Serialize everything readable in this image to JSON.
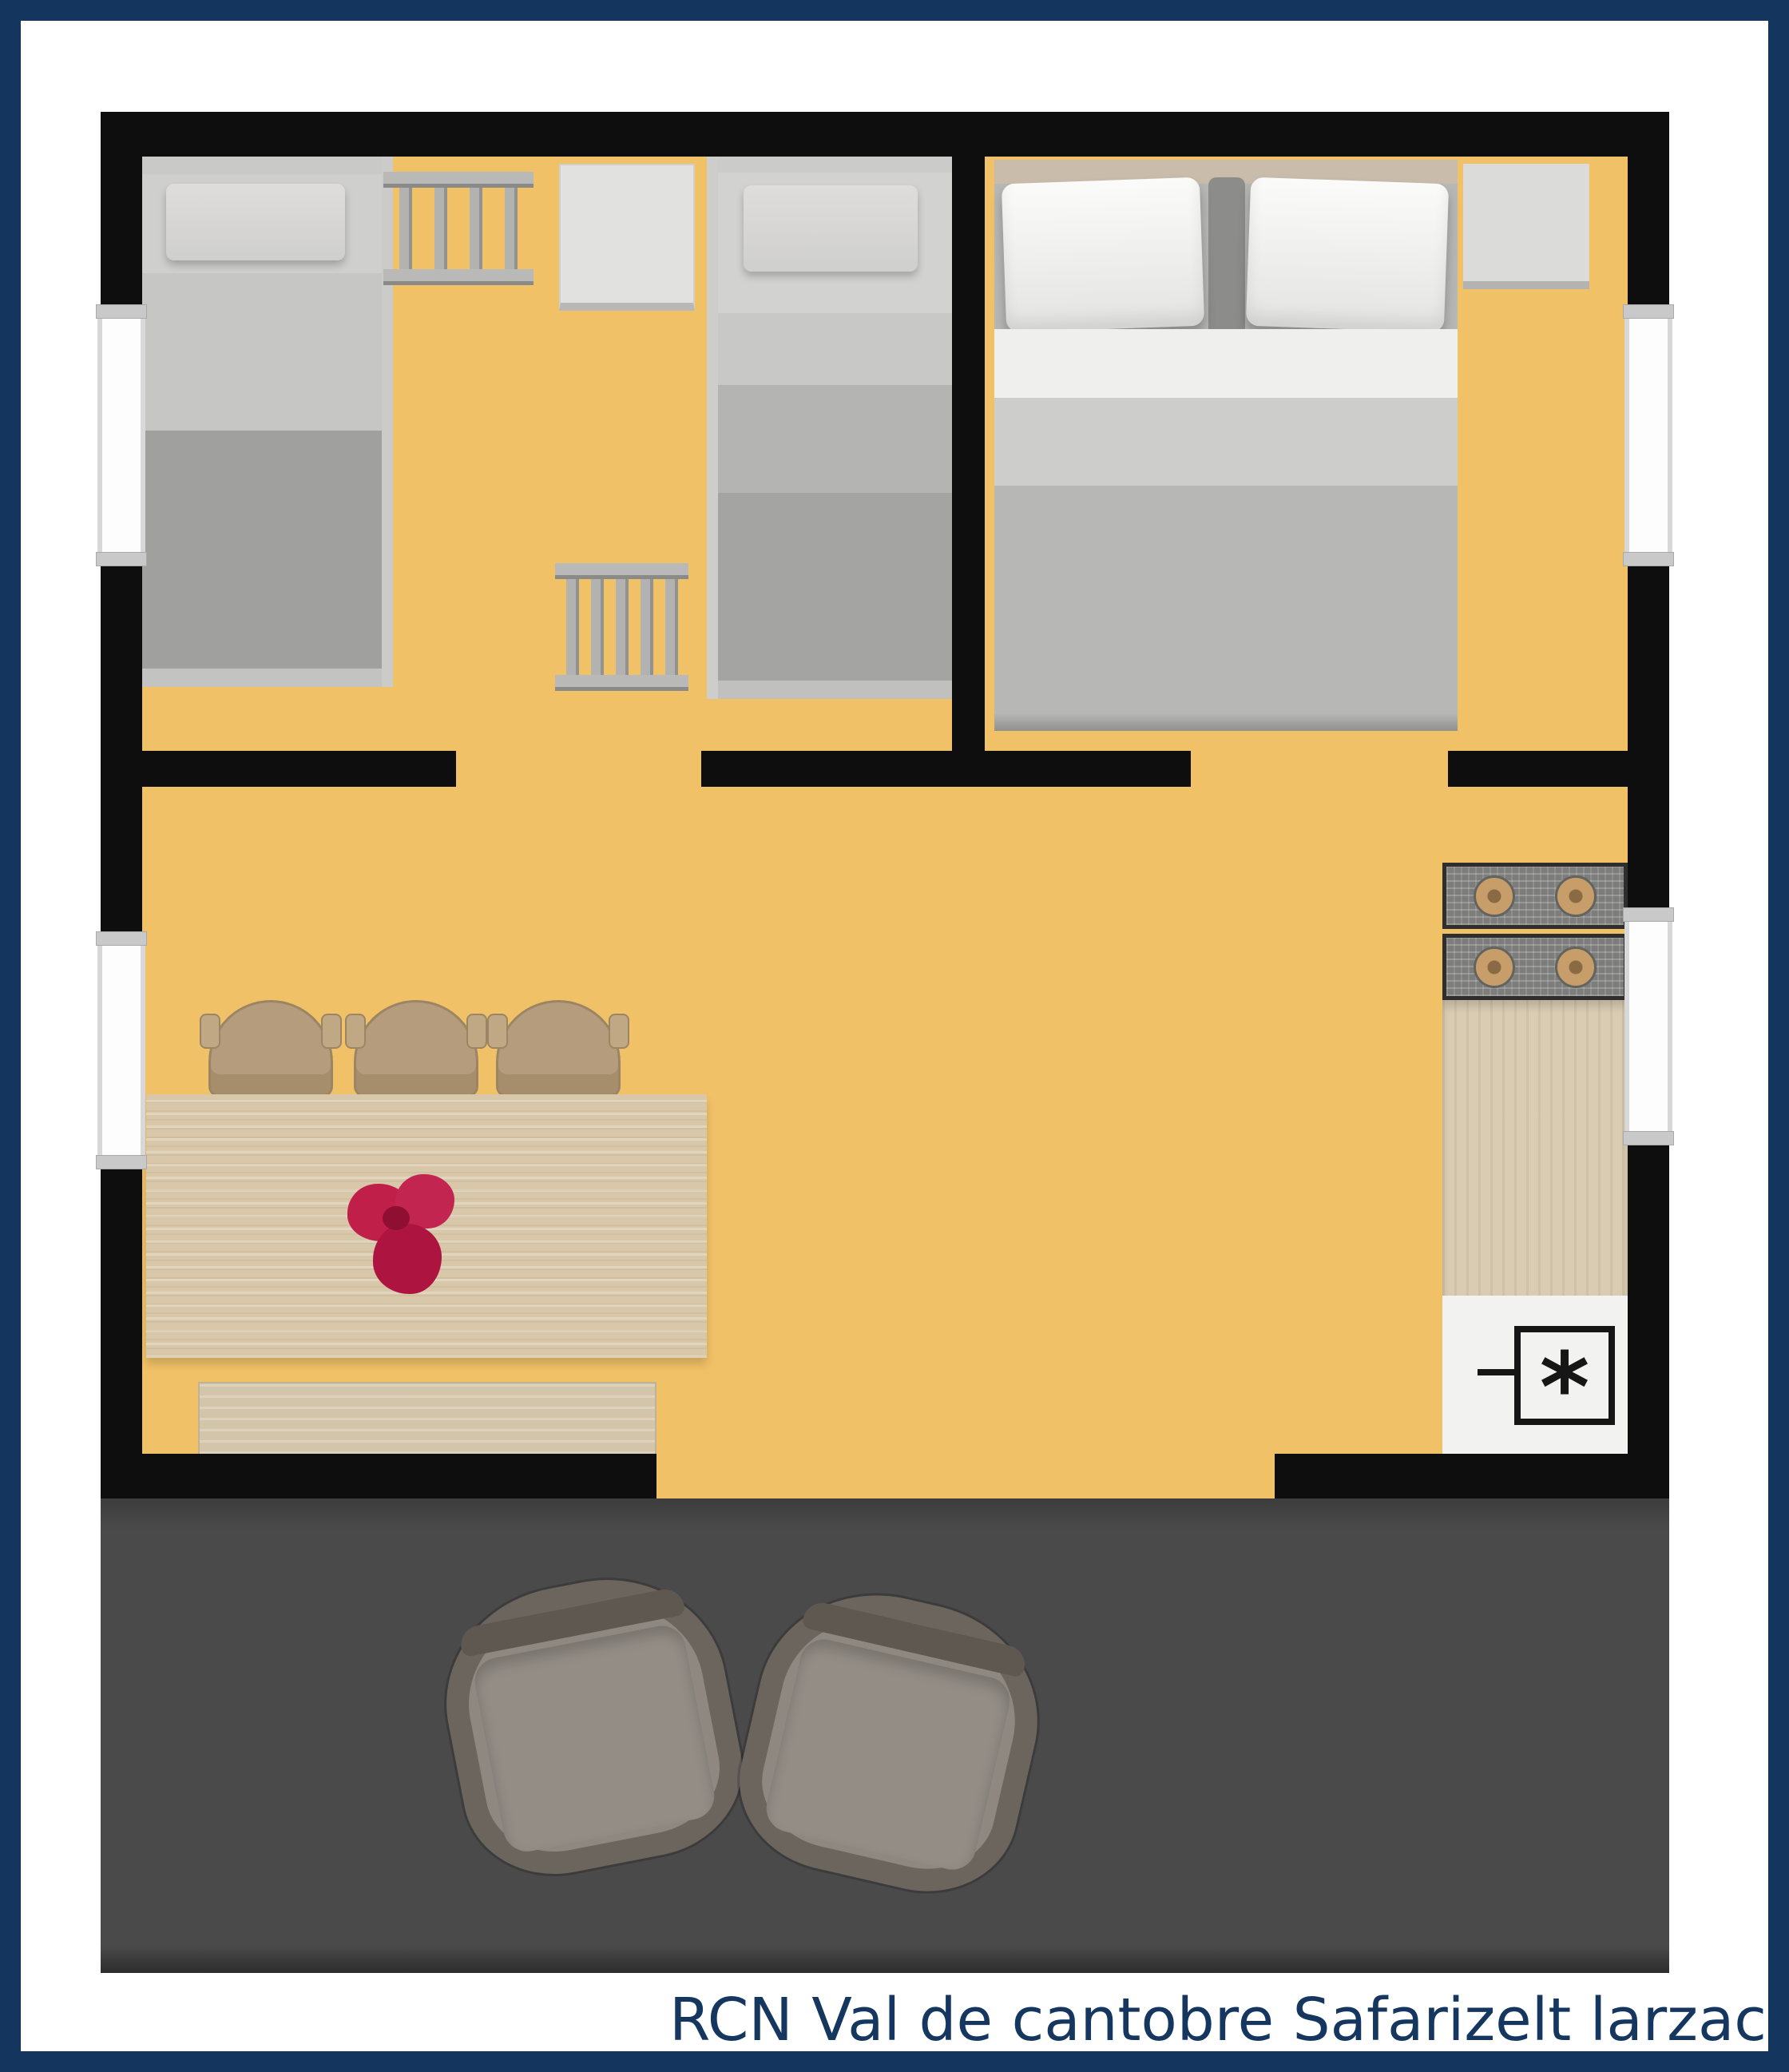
{
  "caption": {
    "text": "RCN Val de cantobre Safarizelt larzac"
  },
  "boiler": {
    "symbol": "*"
  },
  "colors": {
    "frame_navy": "#14365e",
    "background": "#ffffff",
    "wall_black": "#0e0e0e",
    "floor_orange": "#f1c167",
    "terrace_gray": "#4a4a4a",
    "bed_linen_gray": "#c6c6c4",
    "blanket_gray": "#a0a09e",
    "master_pillow_white": "#f7f7f5",
    "headboard_tan": "#c9bcab",
    "wood_table": "#d8c7a9",
    "chair_tan": "#b59c7c",
    "stove_gray": "#7d7d7b",
    "burner_tan": "#c79e6a",
    "flowers_red": "#bf1f48",
    "terrace_chair_gray": "#6b655e",
    "caption_navy": "#15365e"
  },
  "floorplan": {
    "type": "safari-tent-floor-plan",
    "rooms": [
      {
        "name": "children-bedroom",
        "furniture": [
          "single-bunk-bed",
          "single-bunk-bed",
          "bunk-ladder",
          "bunk-ladder",
          "cabinet"
        ]
      },
      {
        "name": "master-bedroom",
        "furniture": [
          "double-bed",
          "nightstand"
        ]
      },
      {
        "name": "living-kitchen",
        "furniture": [
          "dining-table",
          "dining-chair",
          "dining-chair",
          "dining-chair",
          "bench",
          "stove-4-burners",
          "kitchen-counter",
          "water-heater"
        ]
      },
      {
        "name": "terrace",
        "furniture": [
          "lounge-chair",
          "lounge-chair"
        ]
      }
    ],
    "window_count": 4,
    "door_opening_count": 2,
    "decor": "red-flower-bouquet-on-table"
  }
}
